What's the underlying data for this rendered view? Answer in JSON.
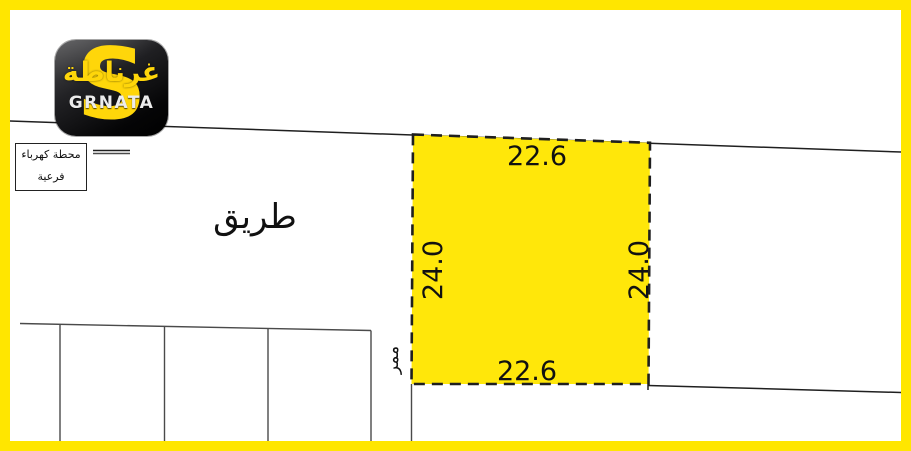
{
  "colors": {
    "frame": "#FFE600",
    "plot_fill": "#FFE70A",
    "line_dark": "#1f1f1f",
    "line_gray": "#4a4a4a",
    "logo_yellow": "#FFD60A",
    "logo_text": "#ECECEC"
  },
  "logo": {
    "arabic": "غرناطة",
    "latin": "GRNATA",
    "s_glyph": "S"
  },
  "labels": {
    "road": "طريق",
    "passage": "ممر",
    "substation": [
      "محطة كهرباء",
      "فرعية"
    ]
  },
  "plot": {
    "top_dim": "22.6",
    "bottom_dim": "22.6",
    "left_dim": "24.0",
    "right_dim": "24.0"
  }
}
